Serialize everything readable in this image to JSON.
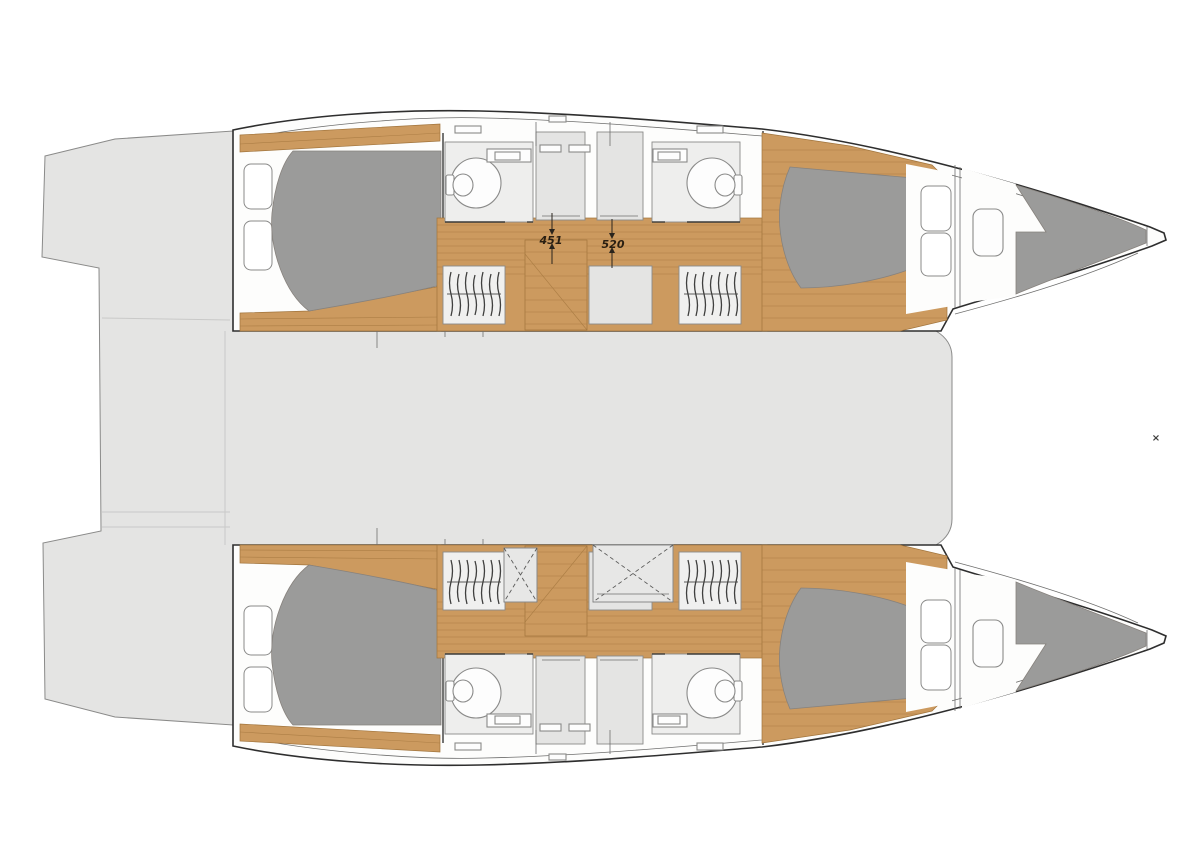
{
  "plan": {
    "type": "catamaran-floor-plan",
    "dimension_labels": [
      {
        "value": "451"
      },
      {
        "value": "520"
      }
    ],
    "corner_marker": "×",
    "colors": {
      "deck": "#e4e4e3",
      "deck_stroke": "#8a8a89",
      "hull_fill": "#fdfdfc",
      "hull_stroke": "#2e2e2e",
      "wood": "#cc9a5f",
      "wood_line": "#a1743c",
      "bed": "#9b9b9a",
      "bed_stroke": "#87827d",
      "pillow": "#ffffff",
      "bath_floor": "#eeeeed",
      "fixture": "#8a8a89",
      "hatch_fill": "#e7e7e6",
      "hatch_line": "#5a5a59",
      "hanger": "#3f3f3e",
      "step_line": "#c9c9c8",
      "dim_text": "#2a1f12",
      "marker": "#3c3c3b"
    }
  }
}
